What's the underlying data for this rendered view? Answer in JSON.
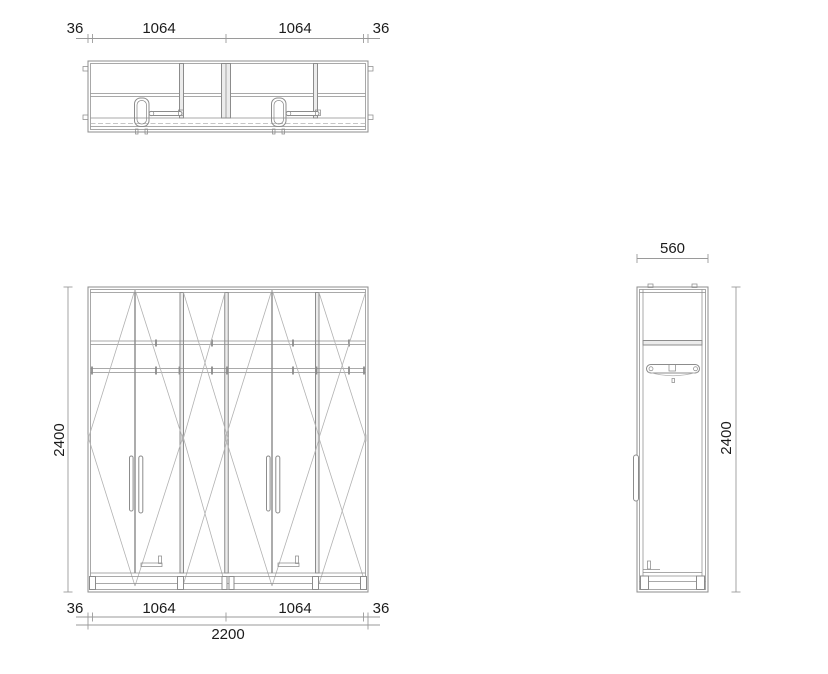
{
  "document": {
    "type": "technical-drawing",
    "subject": "four-door wardrobe, plan / front / side orthographic views"
  },
  "colors": {
    "background": "#ffffff",
    "line": "#8c8c8c",
    "line_dark": "#5a5a5a",
    "line_light": "#b2b2b2",
    "dim_line": "#9a9a9a",
    "text": "#1c1c1c",
    "panel_fill": "#ececec"
  },
  "plan_view": {
    "dims_top": {
      "left_panel": "36",
      "bay1": "1064",
      "bay2": "1064",
      "right_panel": "36"
    }
  },
  "front_view": {
    "dim_height": "2400",
    "dims_bottom": {
      "left_panel": "36",
      "bay1": "1064",
      "bay2": "1064",
      "right_panel": "36",
      "overall_width": "2200"
    }
  },
  "side_view": {
    "dim_depth": "560",
    "dim_height": "2400"
  }
}
